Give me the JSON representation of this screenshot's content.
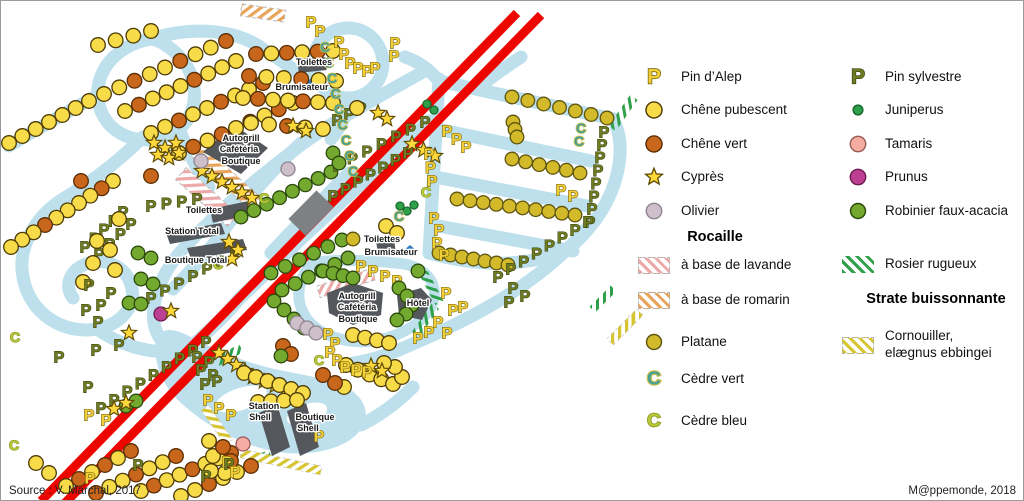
{
  "footer": {
    "source": "Source : V. Marchal, 2017",
    "credit": "M@ppemonde, 2018"
  },
  "colors": {
    "road": "#BDE0EC",
    "highway": "#ED0500",
    "building": "#54575B",
    "bridge": "#7E8184",
    "water_feature": "#2E78C0",
    "chene_pubescent": "#F7DB48",
    "chene_vert": "#C8671B",
    "platane": "#D2BA2B",
    "robinier": "#74A92F",
    "juniperus": "#2E9F4B",
    "tamaris": "#F5ACA2",
    "prunus": "#BC3F92",
    "olivier": "#CEC0CB",
    "cypres": "#FFD83C",
    "pin_alep": "#F1CD37",
    "pin_sylvestre": "#6E7B22",
    "cedre_vert": "#44A095",
    "cedre_bleu": "#B9C93A",
    "hatch_lavande": "#EDA8A8",
    "hatch_romarin": "#E9A45B",
    "hatch_rosier": "#2FA04A",
    "hatch_cornouiller": "#D6C52F"
  },
  "legend": {
    "col1": [
      {
        "symbol": "pin-alep",
        "label": "Pin d’Alep",
        "y": 76
      },
      {
        "symbol": "chene-pubescent",
        "label": "Chêne pubescent",
        "y": 109
      },
      {
        "symbol": "chene-vert",
        "label": "Chêne vert",
        "y": 143
      },
      {
        "symbol": "cypres",
        "label": "Cyprès",
        "y": 176
      },
      {
        "symbol": "olivier",
        "label": "Olivier",
        "y": 210
      },
      {
        "heading": "Rocaille",
        "y": 238
      },
      {
        "symbol": "rocaille-lavande",
        "label": "à base de lavande",
        "y": 264
      },
      {
        "symbol": "rocaille-romarin",
        "label": "à base de romarin",
        "y": 299
      },
      {
        "symbol": "platane",
        "label": "Platane",
        "y": 341
      },
      {
        "symbol": "cedre-vert",
        "label": "Cèdre vert",
        "y": 378
      },
      {
        "symbol": "cedre-bleu",
        "label": "Cèdre bleu",
        "y": 420
      }
    ],
    "col2": [
      {
        "symbol": "pin-sylvestre",
        "label": "Pin sylvestre",
        "y": 76
      },
      {
        "symbol": "juniperus",
        "label": "Juniperus",
        "y": 109
      },
      {
        "symbol": "tamaris",
        "label": "Tamaris",
        "y": 143
      },
      {
        "symbol": "prunus",
        "label": "Prunus",
        "y": 176
      },
      {
        "symbol": "robinier",
        "label": "Robinier faux-acacia",
        "y": 210
      },
      {
        "symbol": "rosier-rugueux",
        "label": "Rosier rugueux",
        "y": 263
      },
      {
        "heading": "Strate buissonnante",
        "y": 300
      },
      {
        "symbol": "cornouiller",
        "label": "Cornouiller,\nelægnus ebbingei",
        "y": 344
      }
    ]
  },
  "map": {
    "labels": [
      {
        "text": "Toilettes",
        "x": 313,
        "y": 64
      },
      {
        "text": "Brumisateur",
        "x": 301,
        "y": 89
      },
      {
        "text": "Autogrill",
        "x": 240,
        "y": 140
      },
      {
        "text": "Cafétéria",
        "x": 238,
        "y": 151
      },
      {
        "text": "Boutique",
        "x": 240,
        "y": 163
      },
      {
        "text": "Toilettes",
        "x": 203,
        "y": 212
      },
      {
        "text": "Station Total",
        "x": 191,
        "y": 233
      },
      {
        "text": "Boutique Total",
        "x": 195,
        "y": 262
      },
      {
        "text": "Toilettes",
        "x": 381,
        "y": 241
      },
      {
        "text": "Brumisateur",
        "x": 390,
        "y": 254
      },
      {
        "text": "Autogrill",
        "x": 356,
        "y": 298
      },
      {
        "text": "Cafétéria",
        "x": 356,
        "y": 309
      },
      {
        "text": "Boutique",
        "x": 357,
        "y": 321
      },
      {
        "text": "Hôtel",
        "x": 417,
        "y": 305
      },
      {
        "text": "Station",
        "x": 263,
        "y": 408
      },
      {
        "text": "Shell",
        "x": 259,
        "y": 419
      },
      {
        "text": "Boutique",
        "x": 314,
        "y": 419
      },
      {
        "text": "Shell",
        "x": 307,
        "y": 430
      }
    ],
    "symbols": {
      "runs": [
        [
          "Y",
          97,
          44,
          150,
          30,
          4
        ],
        [
          "Y+Y+O",
          103,
          93,
          225,
          40,
          9
        ],
        [
          "Y",
          88,
          100,
          8,
          142,
          7
        ],
        [
          "Y+O+Y+Y",
          124,
          110,
          235,
          60,
          9
        ],
        [
          "Y+Y+O",
          150,
          132,
          262,
          82,
          9
        ],
        [
          "Y+O",
          178,
          152,
          292,
          102,
          9
        ],
        [
          "O+Y",
          255,
          53,
          332,
          50,
          6
        ],
        [
          "O+Y+Y",
          248,
          75,
          335,
          80,
          6
        ],
        [
          "Y+O+Y",
          242,
          97,
          332,
          102,
          7
        ],
        [
          "Y+Y+O",
          250,
          122,
          322,
          128,
          5
        ],
        [
          "Y+O+Y+Y+Y",
          112,
          180,
          10,
          246,
          10
        ],
        [
          "PL",
          511,
          96,
          606,
          117,
          7
        ],
        [
          "PL",
          512,
          121,
          516,
          136,
          3
        ],
        [
          "PL",
          511,
          158,
          579,
          172,
          6
        ],
        [
          "PL",
          456,
          198,
          574,
          214,
          10
        ],
        [
          "PL",
          438,
          252,
          507,
          264,
          7
        ],
        [
          "G",
          240,
          216,
          330,
          171,
          8
        ],
        [
          "PS",
          337,
          166,
          424,
          122,
          7
        ],
        [
          "PS",
          150,
          298,
          234,
          254,
          7
        ],
        [
          "PS",
          332,
          196,
          407,
          153,
          7
        ],
        [
          "PS",
          603,
          132,
          589,
          222,
          8
        ],
        [
          "PS",
          497,
          277,
          587,
          222,
          8
        ],
        [
          "PS",
          205,
          342,
          100,
          408,
          9
        ],
        [
          "PS",
          336,
          120,
          360,
          108,
          3
        ],
        [
          "S",
          411,
          143,
          434,
          155,
          3
        ],
        [
          "PA",
          446,
          131,
          465,
          147,
          3
        ],
        [
          "PA",
          428,
          154,
          431,
          181,
          3
        ],
        [
          "G",
          270,
          272,
          341,
          239,
          6
        ],
        [
          "G",
          281,
          289,
          347,
          257,
          6
        ],
        [
          "G",
          273,
          300,
          303,
          327,
          4
        ],
        [
          "PS",
          84,
          247,
          122,
          212,
          5
        ],
        [
          "PS",
          98,
          254,
          130,
          224,
          4
        ],
        [
          "PS",
          150,
          206,
          196,
          199,
          4
        ],
        [
          "S",
          201,
          170,
          251,
          197,
          6
        ],
        [
          "CV",
          324,
          46,
          352,
          170,
          9
        ],
        [
          "G",
          322,
          270,
          352,
          277,
          4
        ],
        [
          "PA",
          360,
          266,
          396,
          281,
          4
        ],
        [
          "S",
          218,
          352,
          244,
          370,
          4
        ],
        [
          "S",
          252,
          376,
          285,
          389,
          4
        ],
        [
          "Y",
          243,
          372,
          302,
          392,
          6
        ],
        [
          "Y",
          257,
          401,
          296,
          399,
          4
        ],
        [
          "Y+O",
          65,
          485,
          130,
          450,
          6
        ],
        [
          "O+Y+Y",
          95,
          492,
          175,
          455,
          7
        ],
        [
          "Y+O+Y",
          140,
          490,
          230,
          452,
          8
        ],
        [
          "Y+Y+O",
          180,
          495,
          250,
          465,
          6
        ],
        [
          "Y",
          352,
          334,
          388,
          342,
          4
        ],
        [
          "Y",
          345,
          364,
          392,
          383,
          5
        ]
      ],
      "singles": [
        [
          "Y",
          118,
          218
        ],
        [
          "Y",
          96,
          240
        ],
        [
          "Y",
          109,
          249
        ],
        [
          "Y",
          92,
          262
        ],
        [
          "Y",
          114,
          269
        ],
        [
          "Y",
          82,
          281
        ],
        [
          "Y",
          35,
          462
        ],
        [
          "Y",
          48,
          472
        ],
        [
          "Y",
          385,
          225
        ],
        [
          "Y",
          396,
          232
        ],
        [
          "Y",
          343,
          386
        ],
        [
          "Y",
          401,
          376
        ],
        [
          "Y",
          394,
          366
        ],
        [
          "Y",
          383,
          362
        ],
        [
          "Y",
          208,
          440
        ],
        [
          "Y",
          212,
          455
        ],
        [
          "Y",
          224,
          472
        ],
        [
          "Y",
          210,
          470
        ],
        [
          "Y",
          356,
          107
        ],
        [
          "O",
          150,
          175
        ],
        [
          "O",
          80,
          180
        ],
        [
          "O",
          282,
          345
        ],
        [
          "O",
          290,
          353
        ],
        [
          "O",
          322,
          374
        ],
        [
          "O",
          334,
          382
        ],
        [
          "O",
          222,
          446
        ],
        [
          "O",
          230,
          460
        ],
        [
          "PL",
          352,
          238
        ],
        [
          "G",
          137,
          252
        ],
        [
          "G",
          150,
          257
        ],
        [
          "G",
          140,
          278
        ],
        [
          "G",
          152,
          283
        ],
        [
          "G",
          128,
          302
        ],
        [
          "G",
          140,
          303
        ],
        [
          "G",
          332,
          152
        ],
        [
          "G",
          338,
          162
        ],
        [
          "G",
          280,
          355
        ],
        [
          "G",
          125,
          405
        ],
        [
          "G",
          135,
          400
        ],
        [
          "G",
          398,
          287
        ],
        [
          "G",
          406,
          295
        ],
        [
          "G",
          411,
          304
        ],
        [
          "G",
          405,
          313
        ],
        [
          "G",
          396,
          319
        ],
        [
          "G",
          417,
          270
        ],
        [
          "J",
          399,
          205
        ],
        [
          "J",
          406,
          210
        ],
        [
          "J",
          413,
          204
        ],
        [
          "J",
          426,
          103
        ],
        [
          "J",
          433,
          109
        ],
        [
          "T",
          242,
          443
        ],
        [
          "PR",
          160,
          313
        ],
        [
          "OL",
          200,
          160
        ],
        [
          "OL",
          287,
          168
        ],
        [
          "OL",
          296,
          322
        ],
        [
          "OL",
          306,
          327
        ],
        [
          "OL",
          315,
          332
        ],
        [
          "CV",
          580,
          127
        ],
        [
          "CV",
          578,
          140
        ],
        [
          "CV",
          398,
          215
        ],
        [
          "CB",
          217,
          263
        ],
        [
          "CB",
          263,
          197
        ],
        [
          "CB",
          425,
          191
        ],
        [
          "CB",
          318,
          359
        ],
        [
          "CB",
          14,
          336
        ],
        [
          "CB",
          13,
          444
        ],
        [
          "S",
          153,
          142
        ],
        [
          "S",
          164,
          147
        ],
        [
          "S",
          175,
          142
        ],
        [
          "S",
          157,
          154
        ],
        [
          "S",
          168,
          157
        ],
        [
          "S",
          178,
          152
        ],
        [
          "S",
          228,
          241
        ],
        [
          "S",
          237,
          249
        ],
        [
          "S",
          231,
          258
        ],
        [
          "S",
          292,
          125
        ],
        [
          "S",
          305,
          130
        ],
        [
          "S",
          170,
          310
        ],
        [
          "S",
          128,
          332
        ],
        [
          "S",
          370,
          365
        ],
        [
          "S",
          381,
          370
        ],
        [
          "S",
          113,
          408
        ],
        [
          "S",
          125,
          402
        ],
        [
          "S",
          377,
          112
        ],
        [
          "S",
          386,
          118
        ],
        [
          "PA",
          310,
          22
        ],
        [
          "PA",
          319,
          31
        ],
        [
          "PA",
          338,
          42
        ],
        [
          "PA",
          343,
          54
        ],
        [
          "PA",
          349,
          63
        ],
        [
          "PA",
          357,
          68
        ],
        [
          "PA",
          366,
          71
        ],
        [
          "PA",
          374,
          68
        ],
        [
          "PA",
          394,
          43
        ],
        [
          "PA",
          393,
          56
        ],
        [
          "PA",
          433,
          218
        ],
        [
          "PA",
          438,
          230
        ],
        [
          "PA",
          436,
          243
        ],
        [
          "PA",
          443,
          255
        ],
        [
          "PA",
          560,
          190
        ],
        [
          "PA",
          572,
          196
        ],
        [
          "PA",
          445,
          293
        ],
        [
          "PA",
          452,
          310
        ],
        [
          "PA",
          462,
          307
        ],
        [
          "PA",
          437,
          322
        ],
        [
          "PA",
          446,
          333
        ],
        [
          "PA",
          428,
          332
        ],
        [
          "PA",
          417,
          338
        ],
        [
          "PA",
          327,
          334
        ],
        [
          "PA",
          334,
          343
        ],
        [
          "PA",
          329,
          352
        ],
        [
          "PA",
          336,
          360
        ],
        [
          "PA",
          344,
          367
        ],
        [
          "PA",
          355,
          370
        ],
        [
          "PA",
          366,
          372
        ],
        [
          "PA",
          207,
          400
        ],
        [
          "PA",
          218,
          408
        ],
        [
          "PA",
          230,
          415
        ],
        [
          "PA",
          226,
          462
        ],
        [
          "PA",
          234,
          472
        ],
        [
          "PA",
          318,
          436
        ],
        [
          "PA",
          89,
          478
        ],
        [
          "PA",
          88,
          415
        ],
        [
          "PA",
          105,
          420
        ],
        [
          "PS",
          88,
          285
        ],
        [
          "PS",
          110,
          293
        ],
        [
          "PS",
          100,
          305
        ],
        [
          "PS",
          85,
          310
        ],
        [
          "PS",
          97,
          322
        ],
        [
          "PS",
          58,
          357
        ],
        [
          "PS",
          95,
          350
        ],
        [
          "PS",
          87,
          387
        ],
        [
          "PS",
          118,
          345
        ],
        [
          "PS",
          196,
          357
        ],
        [
          "PS",
          208,
          362
        ],
        [
          "PS",
          200,
          370
        ],
        [
          "PS",
          212,
          375
        ],
        [
          "PS",
          204,
          384
        ],
        [
          "PS",
          216,
          381
        ],
        [
          "PS",
          137,
          465
        ],
        [
          "PS",
          205,
          476
        ],
        [
          "PS",
          228,
          464
        ],
        [
          "PS",
          512,
          288
        ],
        [
          "PS",
          524,
          296
        ],
        [
          "PS",
          508,
          302
        ]
      ]
    }
  }
}
